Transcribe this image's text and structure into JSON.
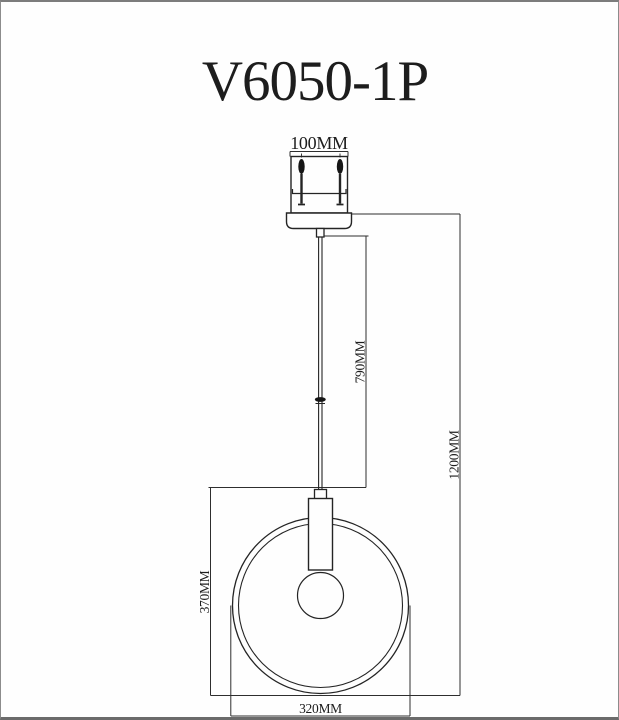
{
  "page": {
    "background_color": "#fefefe",
    "border_color": "#7c7c7c",
    "line_color": "#242424"
  },
  "header": {
    "product_code": "V6050-1P"
  },
  "drawing": {
    "type": "pendant-lamp-technical-drawing",
    "dimensions": {
      "canopy_width": "100MM",
      "cord_length": "790MM",
      "overall_height": "1200MM",
      "shade_height": "370MM",
      "shade_diameter": "320MM"
    }
  }
}
